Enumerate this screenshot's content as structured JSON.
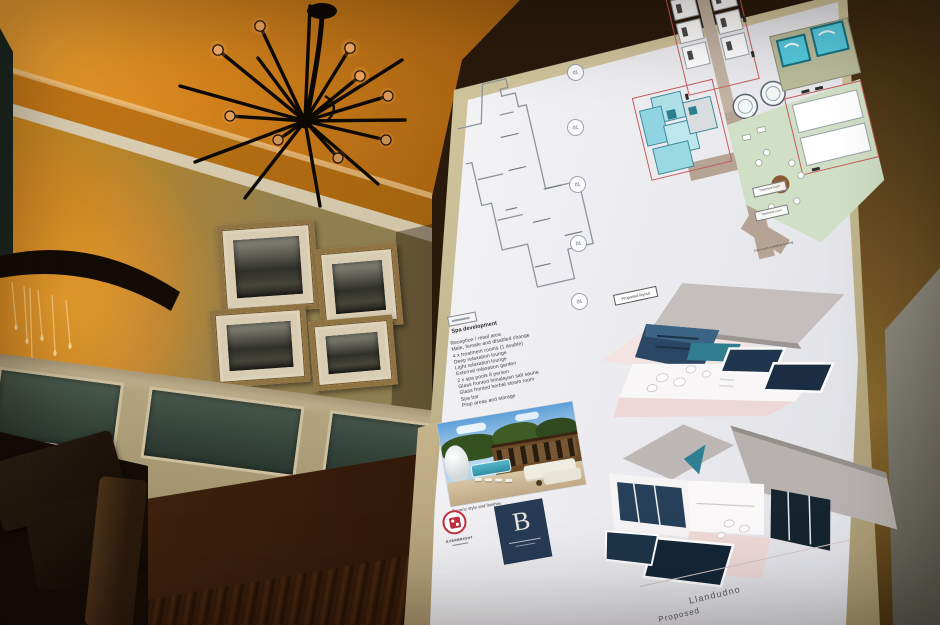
{
  "scene": {
    "setting": "Hotel lounge interior with a spa development presentation board",
    "chandelier": "black sputnik chandelier with exposed bulbs",
    "sconce": "wall sconce with crystal drops and warm orange glow",
    "wall_art": [
      "framed vintage photograph",
      "framed vintage photograph",
      "framed vintage photograph",
      "framed vintage photograph"
    ]
  },
  "poster": {
    "markers": [
      "01",
      "01",
      "01",
      "01",
      "01"
    ],
    "proposed_layout_label": "Proposed layout",
    "plan_labels": {
      "treatment_room_a": "Treatment room",
      "treatment_room_b": "Treatment room",
      "plant_note": "Plant room in existing building"
    },
    "spa": {
      "heading": "Spa development",
      "items": [
        "Reception / retail area",
        "Male, female and disabled change",
        "4 x treatment rooms (1 double)",
        "Deep relaxation lounge",
        "Light relaxation lounge",
        "External relaxation garden",
        "2 x spa pools 8 person",
        "Glass fronted himalayan salt sauna",
        "Glass fronted herbal steam room",
        "Spa bar",
        "Prep areas and storage"
      ]
    },
    "photo_caption": "Generic style and finishes",
    "logos": {
      "everbright": "EVERBRIGHT",
      "monogram": "B"
    },
    "footer": {
      "line1": "Llandudno",
      "line2": "Proposed"
    }
  },
  "colors": {
    "glow_orange": "#e8871e",
    "wall_olive": "#8a7a55",
    "poster_white": "#f4f4f6",
    "board_tan": "#c9bd96",
    "plan_cyan": "#8fd4e0",
    "plan_green": "#d0e0c6",
    "pool_navy": "#1d3348",
    "logo_red": "#c03040",
    "logo_navy": "#273b55"
  }
}
